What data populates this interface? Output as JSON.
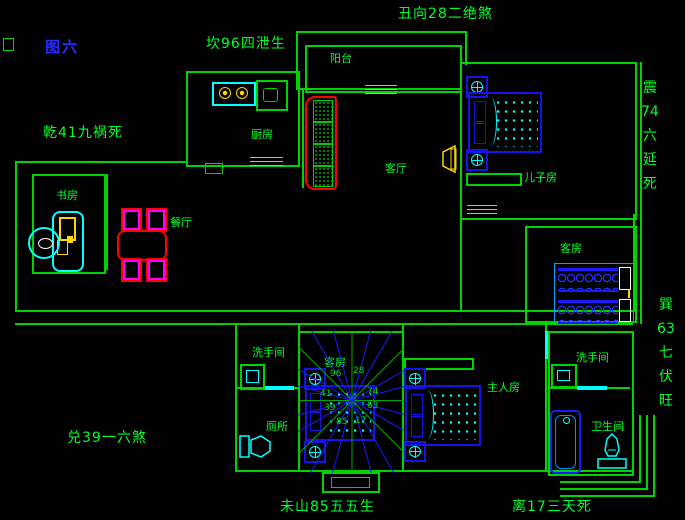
{
  "figure_label": "图六",
  "border_labels": {
    "top_left": "坎96四泄生",
    "top_center": "丑向28二绝煞",
    "left_upper": "乾41九祸死",
    "left_lower": "兑39一六煞",
    "bottom_center": "未山85五五生",
    "bottom_right": "离17三天死",
    "right_upper": [
      "震",
      "74",
      "六",
      "延",
      "死"
    ],
    "right_lower": [
      "巽",
      "63",
      "七",
      "伏",
      "旺"
    ]
  },
  "rooms": {
    "kitchen": "厨房",
    "balcony": "阳台",
    "living_room": "客厅",
    "study": "书房",
    "dining": "餐厅",
    "sons_room": "儿子房",
    "guest_room_east": "客房",
    "guest_room_center": "客房",
    "washroom_west": "洗手间",
    "toilet": "厕所",
    "master_bedroom": "主人房",
    "washroom_east": "洗手间",
    "bathroom": "卫生间"
  },
  "compass": {
    "numbers": [
      "96",
      "28",
      "74",
      "63",
      "41",
      "39",
      "85",
      "17"
    ]
  },
  "colors": {
    "background": "#000000",
    "wall_green": "#00d400",
    "label_green": "#00ff2a",
    "figure_blue": "#2b2bff",
    "furniture_blue": "#1414e6",
    "cyan": "#00ffff",
    "red": "#ff0000",
    "magenta": "#ff00ff",
    "yellow": "#ffd400",
    "white": "#ffffff"
  }
}
